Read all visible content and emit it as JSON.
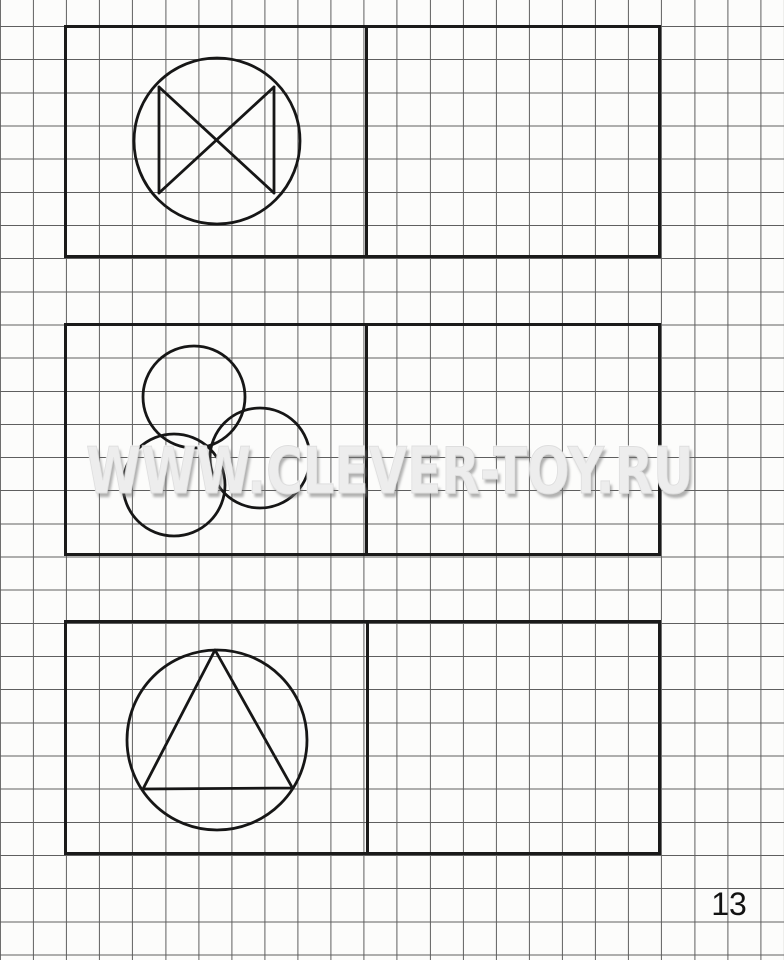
{
  "page": {
    "watermark": "WWW.CLEVER-TOY.RU",
    "number": "13"
  },
  "colors": {
    "paper": "#fcfcfb",
    "grid_line": "#5f5f5f",
    "ink": "#1a1a1a",
    "watermark": "#ededed"
  },
  "grid": {
    "cell_width": 33.06,
    "cell_height": 33.16
  },
  "boxes": [
    {
      "label": "exercise-1",
      "x": 64,
      "y": 25,
      "w": 597,
      "h": 233,
      "divider_x": 365
    },
    {
      "label": "exercise-2",
      "x": 64,
      "y": 323,
      "w": 597,
      "h": 233,
      "divider_x": 365
    },
    {
      "label": "exercise-3",
      "x": 64,
      "y": 620,
      "w": 597,
      "h": 235,
      "divider_x": 366
    }
  ],
  "figures": [
    {
      "name": "circle-with-crossed-square-sides",
      "shapes": [
        {
          "type": "circle",
          "cx": 217,
          "cy": 141,
          "r": 83
        },
        {
          "type": "line",
          "x1": 159,
          "y1": 87,
          "x2": 159,
          "y2": 193
        },
        {
          "type": "line",
          "x1": 274,
          "y1": 87,
          "x2": 274,
          "y2": 193
        },
        {
          "type": "line",
          "x1": 159,
          "y1": 87,
          "x2": 274,
          "y2": 193
        },
        {
          "type": "line",
          "x1": 274,
          "y1": 87,
          "x2": 159,
          "y2": 193
        }
      ]
    },
    {
      "name": "three-overlapping-circles",
      "shapes": [
        {
          "type": "circle",
          "cx": 194,
          "cy": 397,
          "r": 51
        },
        {
          "type": "circle",
          "cx": 174,
          "cy": 485,
          "r": 51
        },
        {
          "type": "circle",
          "cx": 260,
          "cy": 458,
          "r": 50
        }
      ]
    },
    {
      "name": "circle-with-inscribed-triangle",
      "shapes": [
        {
          "type": "circle",
          "cx": 217,
          "cy": 740,
          "r": 90
        },
        {
          "type": "polygon",
          "points": "215,650 292.5,788 143,789"
        }
      ]
    }
  ]
}
